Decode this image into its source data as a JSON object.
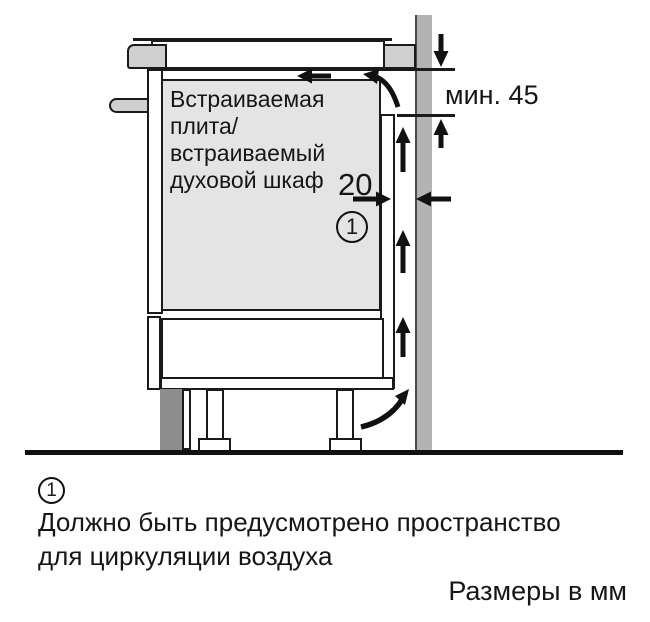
{
  "diagram": {
    "appliance_label": {
      "lines": [
        "Встраиваемая",
        "плита/",
        "встраиваемый",
        "духовой шкаф"
      ]
    },
    "dimensions": {
      "rear_gap_mm": "20",
      "min_top_clearance": "мин. 45"
    },
    "callout": {
      "number": "1"
    },
    "colors": {
      "cabinet_fill": "#e4e4e4",
      "wall_fill": "#b3b3b3",
      "plinth_fill": "#8d8d8d",
      "trim_fill": "#cfcfcf",
      "line": "#1a1a1a"
    }
  },
  "footnote": {
    "marker": "1",
    "lines": [
      "Должно быть предусмотрено пространство",
      "для циркуляции воздуха"
    ]
  },
  "units_note": "Размеры в мм"
}
